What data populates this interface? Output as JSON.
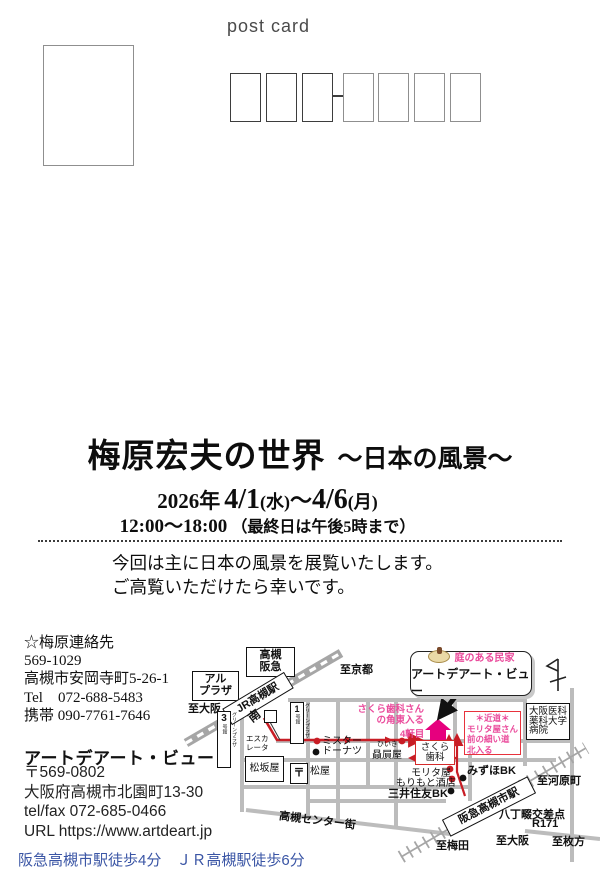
{
  "colors": {
    "accent_pink": "#ea4a9b",
    "marker_magenta": "#e6007e",
    "route_red": "#c81d25",
    "access_blue": "#3a55a5",
    "road_gray": "#bcbcbc"
  },
  "header": {
    "postcard_label": "post card"
  },
  "title": {
    "main": "梅原宏夫の世界",
    "sub": "～日本の風景～"
  },
  "dates": {
    "year": "2026年",
    "start": "4/1",
    "start_day": "(水)",
    "tilde": "～",
    "end": "4/6",
    "end_day": "(月)"
  },
  "hours": {
    "time": "12:00～18:00",
    "note": "（最終日は午後5時まで）"
  },
  "message": {
    "line1": "今回は主に日本の風景を展覧いたします。",
    "line2": "ご高覧いただけたら幸いです。"
  },
  "contact_umehara": {
    "heading": "☆梅原連絡先",
    "postal": "569-1029",
    "address": "高槻市安岡寺町5-26-1",
    "tel": "Tel　072-688-5483",
    "mobile": "携帯 090-7761-7646"
  },
  "gallery": {
    "name": "アートデアート・ビュー",
    "postal": "〒569-0802",
    "address": "大阪府高槻市北園町13-30",
    "telfax": "tel/fax 072-685-0466",
    "url": "URL https://www.artdeart.jp",
    "access": "阪急高槻市駅徒歩4分　ＪＲ高槻駅徒歩6分"
  },
  "map": {
    "hankyu_dept": {
      "l1": "高槻",
      "l2": "阪急"
    },
    "alplaza": {
      "l1": "アル",
      "l2": "プラザ"
    },
    "to_osaka_top": "至大阪",
    "jr_station": "JR高槻駅",
    "to_kyoto": "至京都",
    "south_exit": "南",
    "greenplaza1": {
      "num": "1",
      "bldg": "号館",
      "name": "グリーンプラザ"
    },
    "greenplaza3": {
      "num": "3",
      "bldg": "号館",
      "name": "グリーンプラザ"
    },
    "escalator": {
      "l1": "エスカ",
      "l2": "レータ"
    },
    "matsuzakaya": "松坂屋",
    "post_mark": "〒",
    "matsuya": "松屋",
    "mister_donut": {
      "l1": "ミスター",
      "l2": "ドーナツ"
    },
    "hiiki_kana": "ひいき",
    "hiikiya": "贔屓屋",
    "sakura_note": {
      "l1": "さくら歯科さん",
      "l2": "の角東入る"
    },
    "fourth_house": "4軒目",
    "sakura_dental": {
      "l1": "さくら",
      "l2": "歯科"
    },
    "callout": {
      "tag": "庭のある民家",
      "name": "アートデアート・ビュー"
    },
    "shortcut": {
      "l1": "＊近道＊",
      "l2": "モリタ屋さん",
      "l3": "前の細い道",
      "l4": "北入る"
    },
    "hospital": {
      "l1": "大阪医科",
      "l2": "薬科大学",
      "l3": "病院"
    },
    "moritaya": "モリタ屋",
    "morimoto": "もりもと酒店",
    "mizuho": "みずほBK",
    "mitsui": "三井住友BK",
    "hankyu_station": "阪急高槻市駅",
    "to_kawaramachi": "至河原町",
    "hatchonawate": "八丁畷交差点",
    "r171": "R171",
    "to_osaka_bottom": "至大阪",
    "to_hirakata": "至枚方",
    "to_umeda": "至梅田",
    "center_gai": "高槻センター街"
  }
}
